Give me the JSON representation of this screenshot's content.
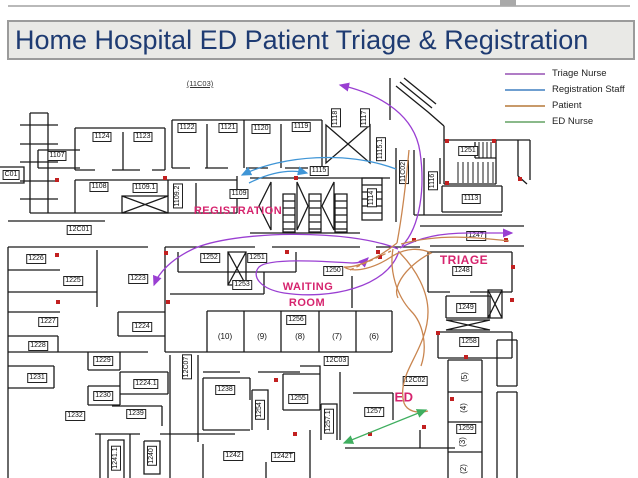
{
  "title": "Home Hospital ED Patient Triage & Registration",
  "legend": {
    "items": [
      {
        "label": "Triage Nurse",
        "color": "#b07cc6"
      },
      {
        "label": "Registration Staff",
        "color": "#6f9fd0"
      },
      {
        "label": "Patient",
        "color": "#c89a6a"
      },
      {
        "label": "ED Nurse",
        "color": "#8ab98a"
      }
    ]
  },
  "map": {
    "accent_color": "#d6246e",
    "area_labels": [
      {
        "text": "REGISTRATION",
        "x": 238,
        "y": 211,
        "size": 11
      },
      {
        "text": "WAITING",
        "x": 308,
        "y": 287,
        "size": 11
      },
      {
        "text": "ROOM",
        "x": 307,
        "y": 303,
        "size": 11
      },
      {
        "text": "TRIAGE",
        "x": 464,
        "y": 260,
        "size": 12
      },
      {
        "text": "ED",
        "x": 404,
        "y": 397,
        "size": 13
      }
    ],
    "rooms": [
      {
        "id": "(11C03)",
        "x": 200,
        "y": 84,
        "u": 1
      },
      {
        "id": "1124",
        "x": 102,
        "y": 137
      },
      {
        "id": "1123",
        "x": 143,
        "y": 137
      },
      {
        "id": "1122",
        "x": 187,
        "y": 128
      },
      {
        "id": "1121",
        "x": 228,
        "y": 128
      },
      {
        "id": "1120",
        "x": 261,
        "y": 129
      },
      {
        "id": "1119",
        "x": 301,
        "y": 127
      },
      {
        "id": "1118",
        "x": 336,
        "y": 118,
        "v": 1
      },
      {
        "id": "1117",
        "x": 365,
        "y": 118,
        "v": 1
      },
      {
        "id": "1115.1",
        "x": 381,
        "y": 149,
        "v": 1
      },
      {
        "id": "1107",
        "x": 57,
        "y": 156
      },
      {
        "id": "C01",
        "x": 11,
        "y": 175
      },
      {
        "id": "1108",
        "x": 99,
        "y": 187
      },
      {
        "id": "1109.1",
        "x": 145,
        "y": 188
      },
      {
        "id": "1109.2",
        "x": 178,
        "y": 196,
        "v": 1
      },
      {
        "id": "1109",
        "x": 239,
        "y": 194
      },
      {
        "id": "1115",
        "x": 319,
        "y": 171
      },
      {
        "id": "11C02",
        "x": 404,
        "y": 172,
        "v": 1
      },
      {
        "id": "1116",
        "x": 433,
        "y": 181,
        "v": 1
      },
      {
        "id": "1251",
        "x": 468,
        "y": 151
      },
      {
        "id": "1113",
        "x": 471,
        "y": 199
      },
      {
        "id": "12C01",
        "x": 79,
        "y": 230
      },
      {
        "id": "1114",
        "x": 372,
        "y": 198,
        "v": 1
      },
      {
        "id": "1247",
        "x": 476,
        "y": 236
      },
      {
        "id": "1226",
        "x": 36,
        "y": 259
      },
      {
        "id": "1225",
        "x": 73,
        "y": 281
      },
      {
        "id": "1223",
        "x": 138,
        "y": 279
      },
      {
        "id": "1252",
        "x": 210,
        "y": 258
      },
      {
        "id": "1251",
        "x": 257,
        "y": 258
      },
      {
        "id": "1250",
        "x": 333,
        "y": 271
      },
      {
        "id": "1253",
        "x": 242,
        "y": 285
      },
      {
        "id": "1248",
        "x": 462,
        "y": 271
      },
      {
        "id": "1227",
        "x": 48,
        "y": 322
      },
      {
        "id": "1224",
        "x": 142,
        "y": 327
      },
      {
        "id": "1249",
        "x": 466,
        "y": 308
      },
      {
        "id": "1256",
        "x": 296,
        "y": 320
      },
      {
        "id": "1228",
        "x": 38,
        "y": 346
      },
      {
        "id": "1258",
        "x": 469,
        "y": 342
      },
      {
        "id": "(10)",
        "x": 225,
        "y": 337,
        "box": 0
      },
      {
        "id": "(9)",
        "x": 262,
        "y": 337,
        "box": 0
      },
      {
        "id": "(8)",
        "x": 300,
        "y": 337,
        "box": 0
      },
      {
        "id": "(7)",
        "x": 337,
        "y": 337,
        "box": 0
      },
      {
        "id": "(6)",
        "x": 374,
        "y": 337,
        "box": 0
      },
      {
        "id": "12C03",
        "x": 336,
        "y": 361
      },
      {
        "id": "1231",
        "x": 37,
        "y": 378
      },
      {
        "id": "1229",
        "x": 103,
        "y": 361
      },
      {
        "id": "12C07",
        "x": 187,
        "y": 367,
        "v": 1
      },
      {
        "id": "1238",
        "x": 225,
        "y": 390
      },
      {
        "id": "1230",
        "x": 103,
        "y": 396
      },
      {
        "id": "1224.1",
        "x": 146,
        "y": 384
      },
      {
        "id": "1232",
        "x": 75,
        "y": 416
      },
      {
        "id": "1239",
        "x": 136,
        "y": 414
      },
      {
        "id": "1254",
        "x": 260,
        "y": 410,
        "v": 1
      },
      {
        "id": "1255",
        "x": 298,
        "y": 399
      },
      {
        "id": "1257.1",
        "x": 329,
        "y": 421,
        "v": 1
      },
      {
        "id": "1257",
        "x": 374,
        "y": 412
      },
      {
        "id": "12C02",
        "x": 415,
        "y": 381
      },
      {
        "id": "(5)",
        "x": 465,
        "y": 377,
        "v": 1,
        "box": 0
      },
      {
        "id": "(4)",
        "x": 464,
        "y": 408,
        "v": 1,
        "box": 0
      },
      {
        "id": "1259",
        "x": 466,
        "y": 429
      },
      {
        "id": "(3)",
        "x": 463,
        "y": 442,
        "v": 1,
        "box": 0
      },
      {
        "id": "(2)",
        "x": 464,
        "y": 469,
        "v": 1,
        "box": 0
      },
      {
        "id": "1241.1",
        "x": 116,
        "y": 458,
        "v": 1
      },
      {
        "id": "1240",
        "x": 152,
        "y": 456,
        "v": 1
      },
      {
        "id": "1242",
        "x": 233,
        "y": 456
      },
      {
        "id": "1242T",
        "x": 283,
        "y": 457
      }
    ],
    "flows": [
      {
        "id": "triage-nurse-exit-top",
        "color": "#9a3fd2",
        "d": "M402,246 C421,226 425,186 420,152 C415,117 384,95 340,85",
        "end": true
      },
      {
        "id": "triage-nurse-to-1247",
        "color": "#9a3fd2",
        "d": "M400,248 C420,237 442,233 468,233 L512,233",
        "end": true
      },
      {
        "id": "triage-nurse-to-left",
        "color": "#9a3fd2",
        "d": "M398,249 C348,228 232,231 193,249 C172,259 159,272 154,285",
        "end": true
      },
      {
        "id": "triage-nurse-loop",
        "color": "#9a3fd2",
        "d": "M399,251 C388,287 330,300 284,293 C260,289 251,276 259,267 C268,258 320,261 352,263 C360,263 365,261 368,258",
        "end": true
      },
      {
        "id": "registration-to-left",
        "color": "#3f95d6",
        "d": "M396,169 C348,151 283,155 242,175",
        "end": true
      },
      {
        "id": "registration-to-1115",
        "color": "#3f95d6",
        "d": "M249,183 C271,172 291,169 307,173",
        "end": true
      },
      {
        "id": "patient-entry",
        "color": "#c9854f",
        "d": "M409,150 C406,183 402,216 397,243"
      },
      {
        "id": "patient-tangle",
        "color": "#c9854f",
        "d": "M397,243 C377,259 357,268 344,267 C355,274 376,267 391,257 C406,247 421,248 431,253 C419,259 407,269 401,279 C397,286 395,292 398,298"
      },
      {
        "id": "patient-to-1247",
        "color": "#c9854f",
        "d": "M401,244 C427,237 452,236 477,238 C492,239 501,240 509,241"
      },
      {
        "id": "patient-to-ed",
        "color": "#c9854f",
        "d": "M399,252 C417,270 428,292 428,312 C428,336 414,356 407,373 C403,383 401,393 404,403 C407,411 417,414 428,411"
      },
      {
        "id": "patient-strand-2",
        "color": "#c9854f",
        "d": "M393,249 C389,271 397,296 411,311 C423,323 428,346 421,366"
      },
      {
        "id": "patient-dashed",
        "color": "#c9854f",
        "d": "M350,270 C365,263 379,257 391,251",
        "dash": "4 3"
      },
      {
        "id": "ed-nurse",
        "color": "#3fae5f",
        "d": "M344,443 L426,410",
        "end": true,
        "start": true
      }
    ],
    "door_markers": [
      [
        57,
        180
      ],
      [
        165,
        178
      ],
      [
        296,
        178
      ],
      [
        380,
        257
      ],
      [
        414,
        240
      ],
      [
        506,
        240
      ],
      [
        57,
        255
      ],
      [
        166,
        253
      ],
      [
        58,
        302
      ],
      [
        168,
        302
      ],
      [
        276,
        380
      ],
      [
        295,
        434
      ],
      [
        370,
        434
      ],
      [
        513,
        267
      ],
      [
        512,
        300
      ],
      [
        438,
        333
      ],
      [
        466,
        357
      ],
      [
        452,
        399
      ],
      [
        424,
        427
      ],
      [
        447,
        141
      ],
      [
        494,
        141
      ],
      [
        447,
        183
      ],
      [
        520,
        179
      ],
      [
        287,
        252
      ],
      [
        378,
        252
      ]
    ]
  }
}
